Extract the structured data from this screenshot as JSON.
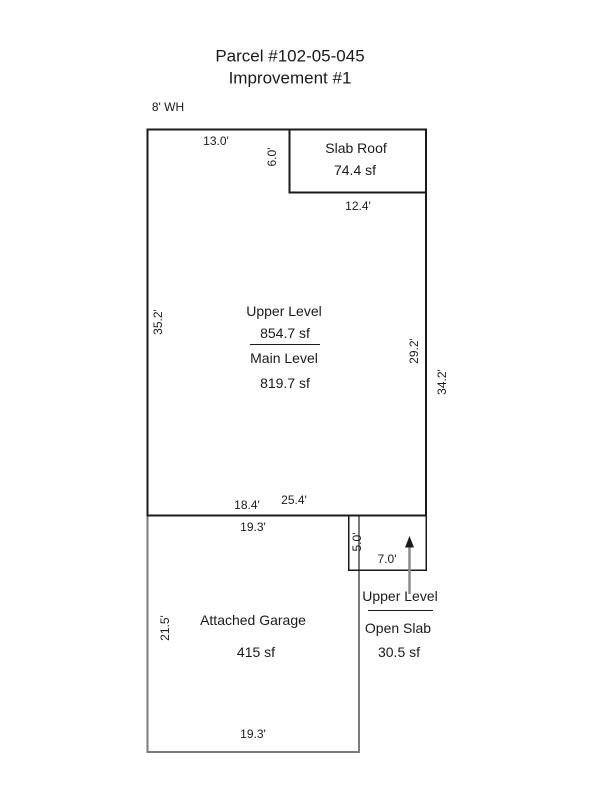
{
  "page": {
    "title_line1": "Parcel #102-05-045",
    "title_line2": "Improvement #1",
    "wall_height": "8' WH"
  },
  "colors": {
    "ink": "#1a1a1a",
    "main_outline": "#1a1a1a",
    "garage_outline": "#7b7b7b",
    "slab_roof_outline": "#1a1a1a",
    "open_slab_outline": "#1a1a1a",
    "arrow_shaft": "#8c8c8c",
    "arrow_head": "#1a1a1a"
  },
  "main_building": {
    "upper_level_name": "Upper Level",
    "upper_level_area": "854.7 sf",
    "main_level_name": "Main Level",
    "main_level_area": "819.7 sf",
    "dim_top": "13.0'",
    "dim_left": "35.2'",
    "dim_right_inner": "29.2'",
    "dim_right_outer": "34.2'",
    "dim_bottom_upper": "18.4'",
    "dim_bottom_main": "25.4'"
  },
  "slab_roof": {
    "name": "Slab Roof",
    "area": "74.4 sf",
    "dim_height": "6.0'",
    "dim_bottom": "12.4'"
  },
  "garage": {
    "name": "Attached Garage",
    "area": "415 sf",
    "dim_top": "19.3'",
    "dim_left": "21.5'",
    "dim_bottom": "19.3'"
  },
  "open_slab": {
    "dim_height": "5.0'",
    "dim_width": "7.0'",
    "callout_line1": "Upper Level",
    "callout_line2": "Open Slab",
    "callout_area": "30.5 sf"
  }
}
